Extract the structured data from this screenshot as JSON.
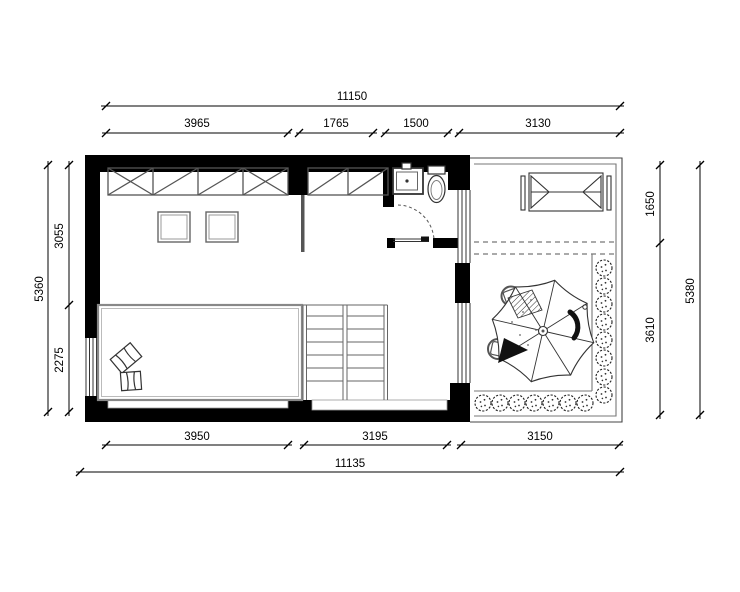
{
  "page": {
    "background": "#ffffff",
    "title": "floor-plan"
  },
  "drawing": {
    "type": "architectural-floor-plan",
    "wall_color": "#000000",
    "line_color": "#333333",
    "dimensions": {
      "top": {
        "overall": "11150",
        "segments": [
          "3965",
          "1765",
          "1500",
          "3130"
        ]
      },
      "bottom": {
        "overall": "11135",
        "segments": [
          "3950",
          "3195",
          "3150"
        ]
      },
      "left": {
        "overall": "5360",
        "segments": [
          "3055",
          "2275"
        ]
      },
      "right": {
        "overall": "5380",
        "segments": [
          "1650",
          "3610"
        ]
      }
    },
    "features": [
      "wardrobe-four-sections",
      "wardrobe-two-sections",
      "two-square-stools",
      "bed-platform-with-cushions",
      "double-flight-staircase",
      "bathroom-sink",
      "toilet",
      "sliding-door-with-swing-arc",
      "windows-in-walls",
      "terrace-with-railing",
      "outdoor-folding-table",
      "parasol-with-two-chairs",
      "shrub-planter-right",
      "shrub-planter-bottom"
    ]
  }
}
